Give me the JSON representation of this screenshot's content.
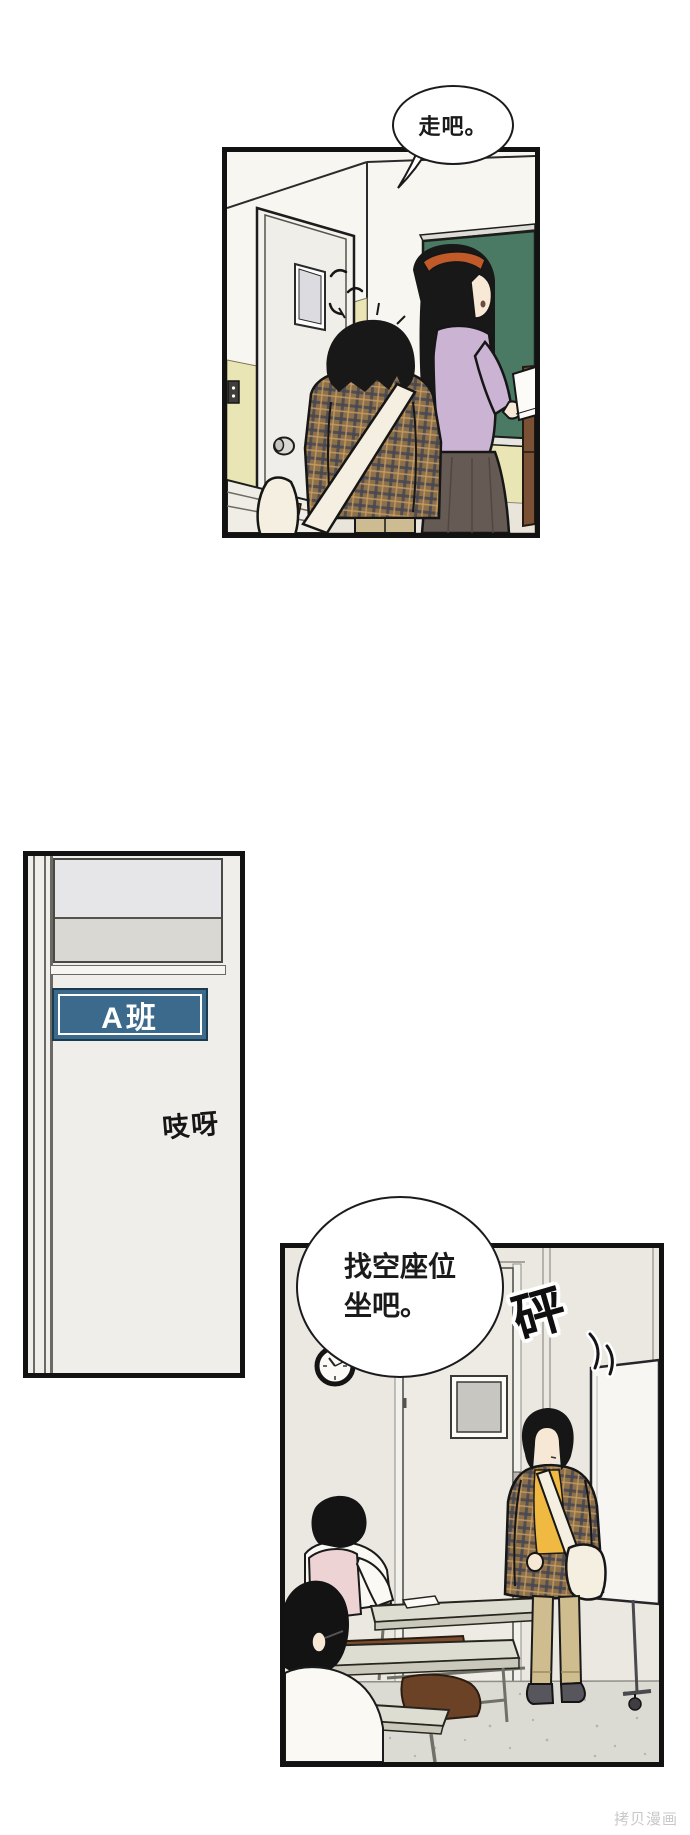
{
  "page": {
    "width": 690,
    "height": 1835,
    "background_color": "#ffffff",
    "watermark": "拷贝漫画"
  },
  "bubbles": {
    "bubble1": {
      "text": "走吧。"
    },
    "bubble2": {
      "line1": "找空座位",
      "line2": "坐吧。"
    }
  },
  "sfx": {
    "door_creak": "吱呀",
    "bang": "砰"
  },
  "door_sign": {
    "label": "A班"
  },
  "panels": {
    "panel1": {
      "alt": "教室黑板前两名学生"
    },
    "panel2": {
      "alt": "A班教室门"
    },
    "panel3": {
      "alt": "教室内找座位"
    }
  },
  "palette": {
    "panel_border": "#121212",
    "chalkboard_green": "#4a7a64",
    "wainscot_yellow": "#eae5b4",
    "door_sign_blue": "#3b6a8c",
    "sweater_lavender": "#cbb3d4",
    "skirt_brown": "#665a55",
    "shirt_yellow": "#f0b942",
    "pants_khaki": "#d0bd8f",
    "vest_pink": "#eed3d4",
    "coat_plaid_base": "#8d7048",
    "bag_cream": "#f4efe1",
    "floor_gray": "#dbdad3",
    "watermark_gray": "#c8c8c8"
  }
}
